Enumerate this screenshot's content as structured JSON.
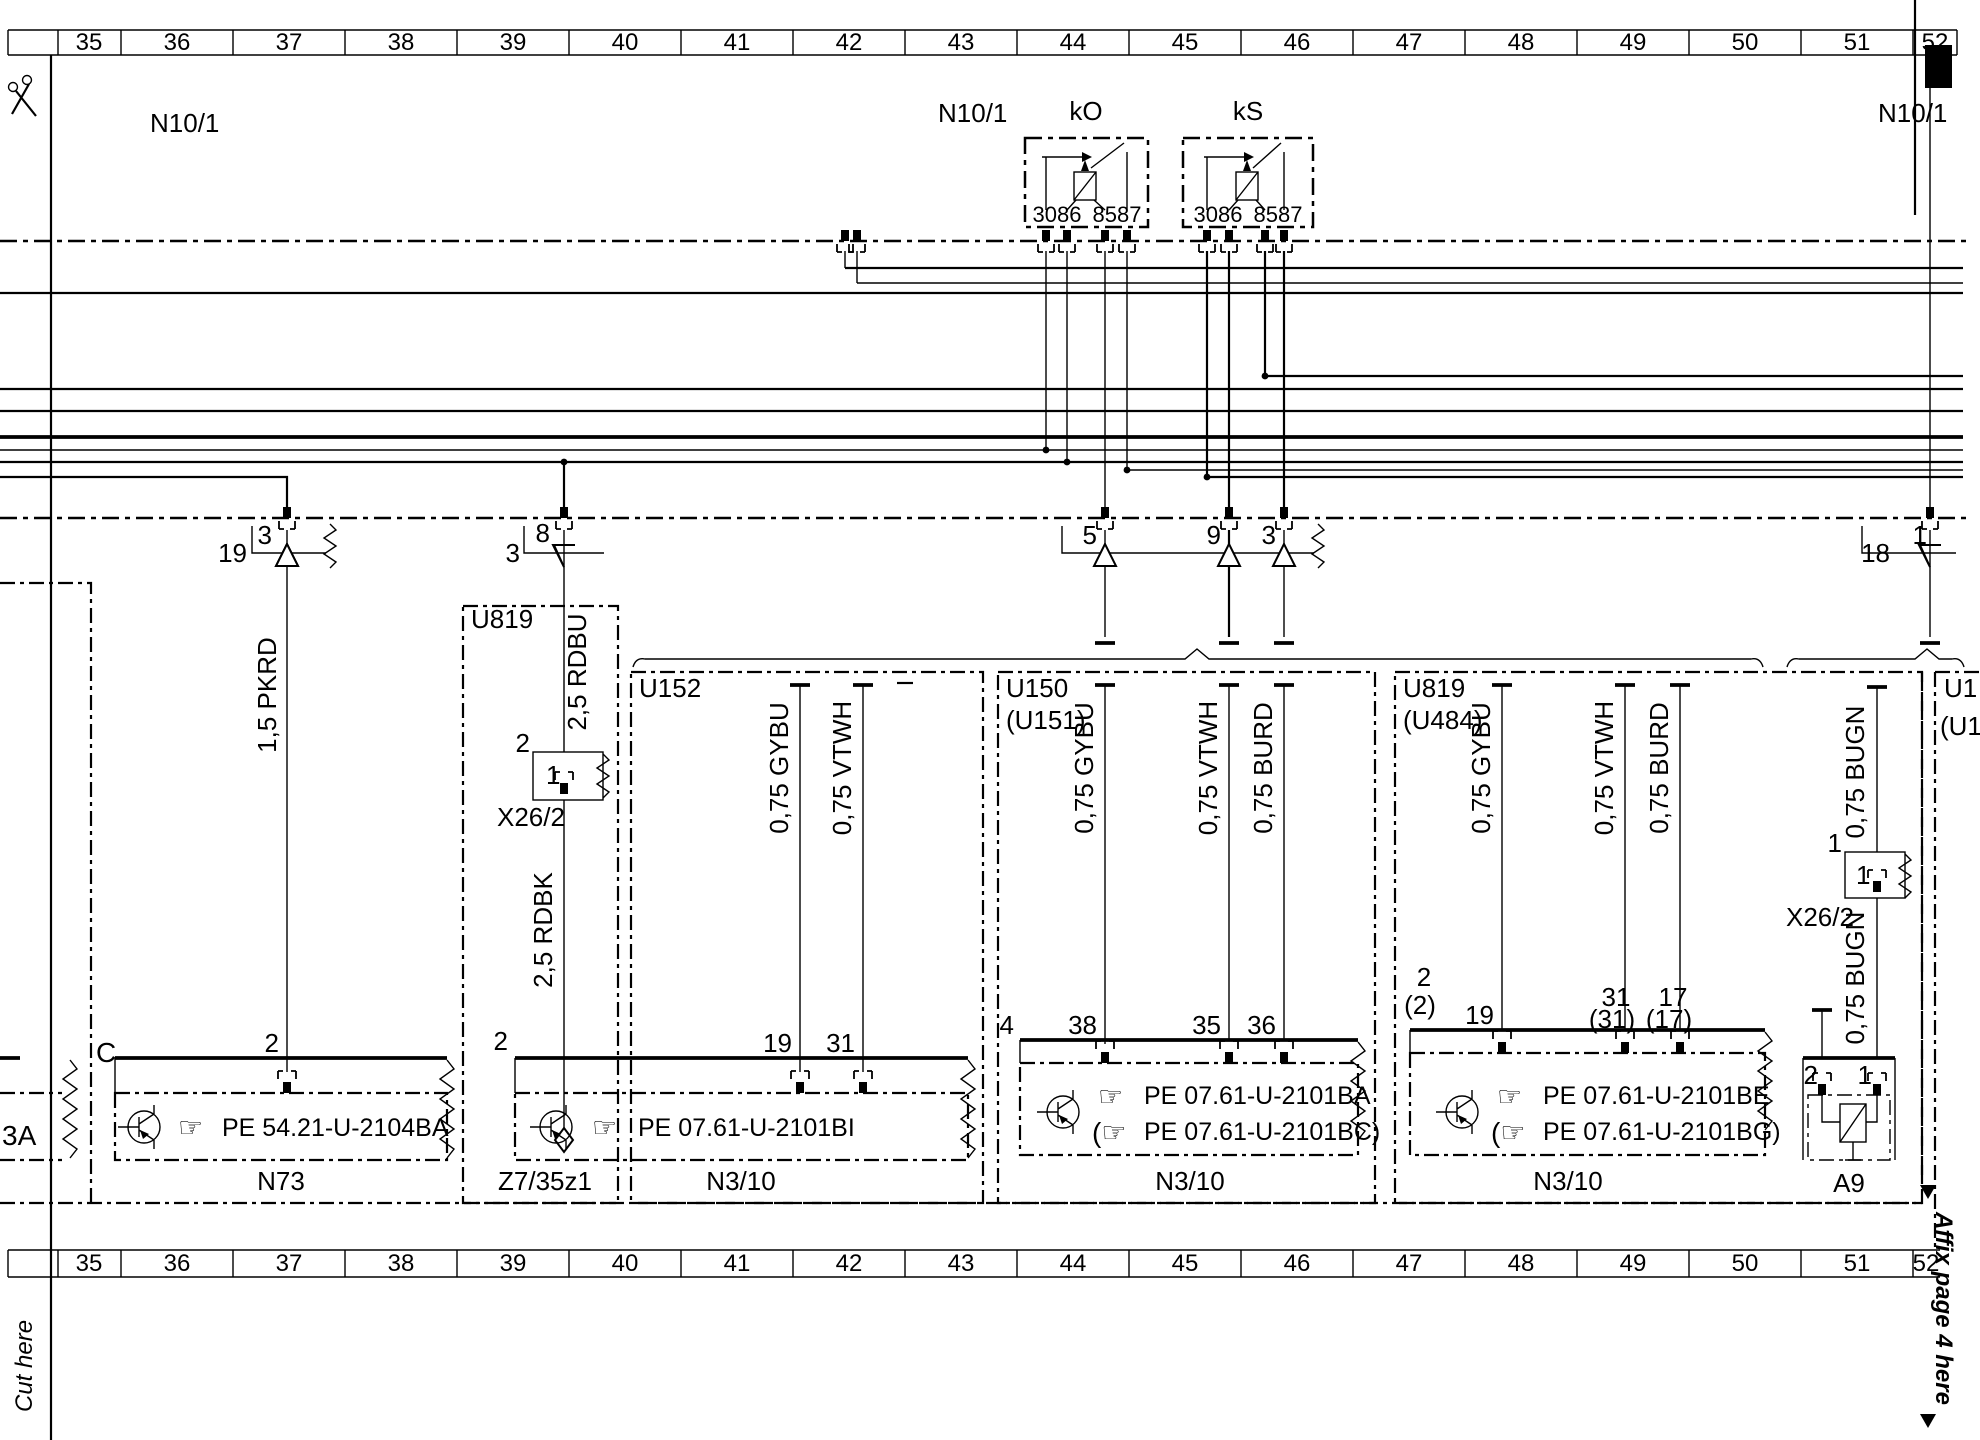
{
  "page": {
    "cut_here": "Cut here",
    "affix_note": "Affix page 4 here"
  },
  "ruler": {
    "cells": [
      "35",
      "36",
      "37",
      "38",
      "39",
      "40",
      "41",
      "42",
      "43",
      "44",
      "45",
      "46",
      "47",
      "48",
      "49",
      "50",
      "51",
      "52"
    ]
  },
  "units": {
    "n10_left": "N10/1",
    "n10_mid": "N10/1",
    "n10_right": "N10/1"
  },
  "relays": {
    "ko": {
      "label": "kO",
      "pins_left": "3086",
      "pins_right": "8587"
    },
    "ks": {
      "label": "kS",
      "pins_left": "3086",
      "pins_right": "8587"
    }
  },
  "connector_row": {
    "c19_out": "19",
    "c19_pin": "3",
    "c3_out": "3",
    "c3_pin": "8",
    "c5": "5",
    "c9": "9",
    "c3r": "3",
    "c18_out": "18",
    "c18_pin": "1"
  },
  "wires": {
    "pkrd": "1,5 PKRD",
    "rdbu": "2,5 RDBU",
    "rdbk": "2,5 RDBK",
    "gybu": "0,75 GYBU",
    "vtwh": "0,75 VTWH",
    "burd": "0,75 BURD",
    "bugn": "0,75 BUGN"
  },
  "boxes": {
    "u819_left": "U819",
    "u152": "U152",
    "u150": "U150",
    "u151": "(U151)",
    "u819_right": "U819",
    "u484": "(U484)",
    "edge_u1": "U1",
    "edge_u1b": "(U1",
    "c_label": "C",
    "cut_component": "3A"
  },
  "x26": {
    "label": "X26/2",
    "pin1": "1",
    "pin2": "2"
  },
  "z7": {
    "label": "Z7/35z1"
  },
  "icons": {
    "hand": "☞",
    "hand_paren": "(☞"
  },
  "components": {
    "n73": {
      "name": "N73",
      "pe": "PE 54.21-U-2104BA",
      "pin2": "2"
    },
    "n310a": {
      "name": "N3/10",
      "pe": "PE 07.61-U-2101BI",
      "pin_left": "2",
      "p19": "19",
      "p31": "31"
    },
    "n310b": {
      "name": "N3/10",
      "pe1": "PE 07.61-U-2101BA",
      "pe2": "PE 07.61-U-2101BC)",
      "pin_left": "4",
      "p38": "38",
      "p35": "35",
      "p36": "36"
    },
    "n310c": {
      "name": "N3/10",
      "pe1": "PE 07.61-U-2101BE",
      "pe2": "PE 07.61-U-2101BG)",
      "pin2": "2",
      "pin2p": "(2)",
      "p19": "19",
      "p31": "31",
      "p31p": "(31)",
      "p17": "17",
      "p17p": "(17)"
    },
    "a9": {
      "name": "A9",
      "p1": "1",
      "p2": "2"
    }
  }
}
